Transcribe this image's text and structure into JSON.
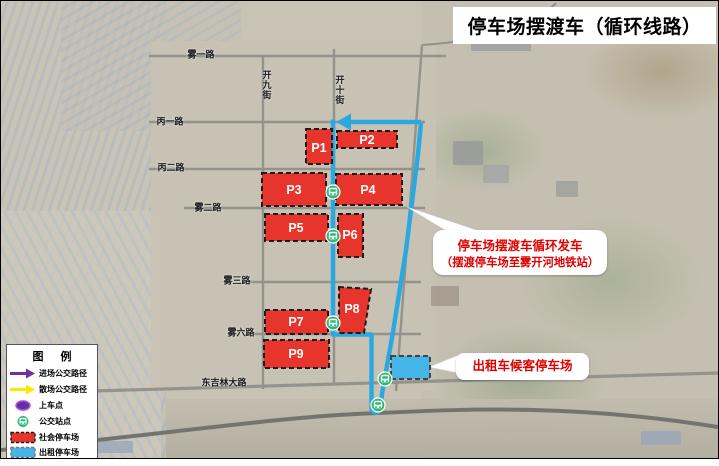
{
  "header": {
    "title": "停车场摆渡车（循环线路）"
  },
  "legend": {
    "title": "图 例",
    "items": [
      {
        "icon": "purple-arrow",
        "label": "进场公交路径"
      },
      {
        "icon": "yellow-arrow",
        "label": "散场公交路径"
      },
      {
        "icon": "boarding-point",
        "label": "上车点"
      },
      {
        "icon": "bus-stop",
        "label": "公交站点"
      },
      {
        "icon": "public-parking",
        "label": "社会停车场"
      },
      {
        "icon": "taxi-parking",
        "label": "出租停车场"
      }
    ]
  },
  "roads": [
    {
      "name": "雾一路"
    },
    {
      "name": "开九街"
    },
    {
      "name": "开十街"
    },
    {
      "name": "丙一路"
    },
    {
      "name": "丙二路"
    },
    {
      "name": "雾二路"
    },
    {
      "name": "雾三路"
    },
    {
      "name": "雾六路"
    },
    {
      "name": "东吉林大路"
    }
  ],
  "parking": {
    "lots": [
      {
        "id": "P1"
      },
      {
        "id": "P2"
      },
      {
        "id": "P3"
      },
      {
        "id": "P4"
      },
      {
        "id": "P5"
      },
      {
        "id": "P6"
      },
      {
        "id": "P7"
      },
      {
        "id": "P8"
      },
      {
        "id": "P9"
      }
    ]
  },
  "annotations": {
    "shuttle": {
      "line1": "停车场摆渡车循环发车",
      "line2": "（摆渡停车场至雾开河地铁站）"
    },
    "taxi": {
      "text": "出租车候客停车场"
    }
  },
  "colors": {
    "route_blue": "#2AA9E0",
    "parking_red": "#E7342C",
    "taxi_parking_blue": "#45B5E8",
    "bus_stop_green": "#2DB973",
    "legend_purple": "#7030A0",
    "legend_yellow": "#FFE800",
    "annotation_red": "#E00000"
  }
}
